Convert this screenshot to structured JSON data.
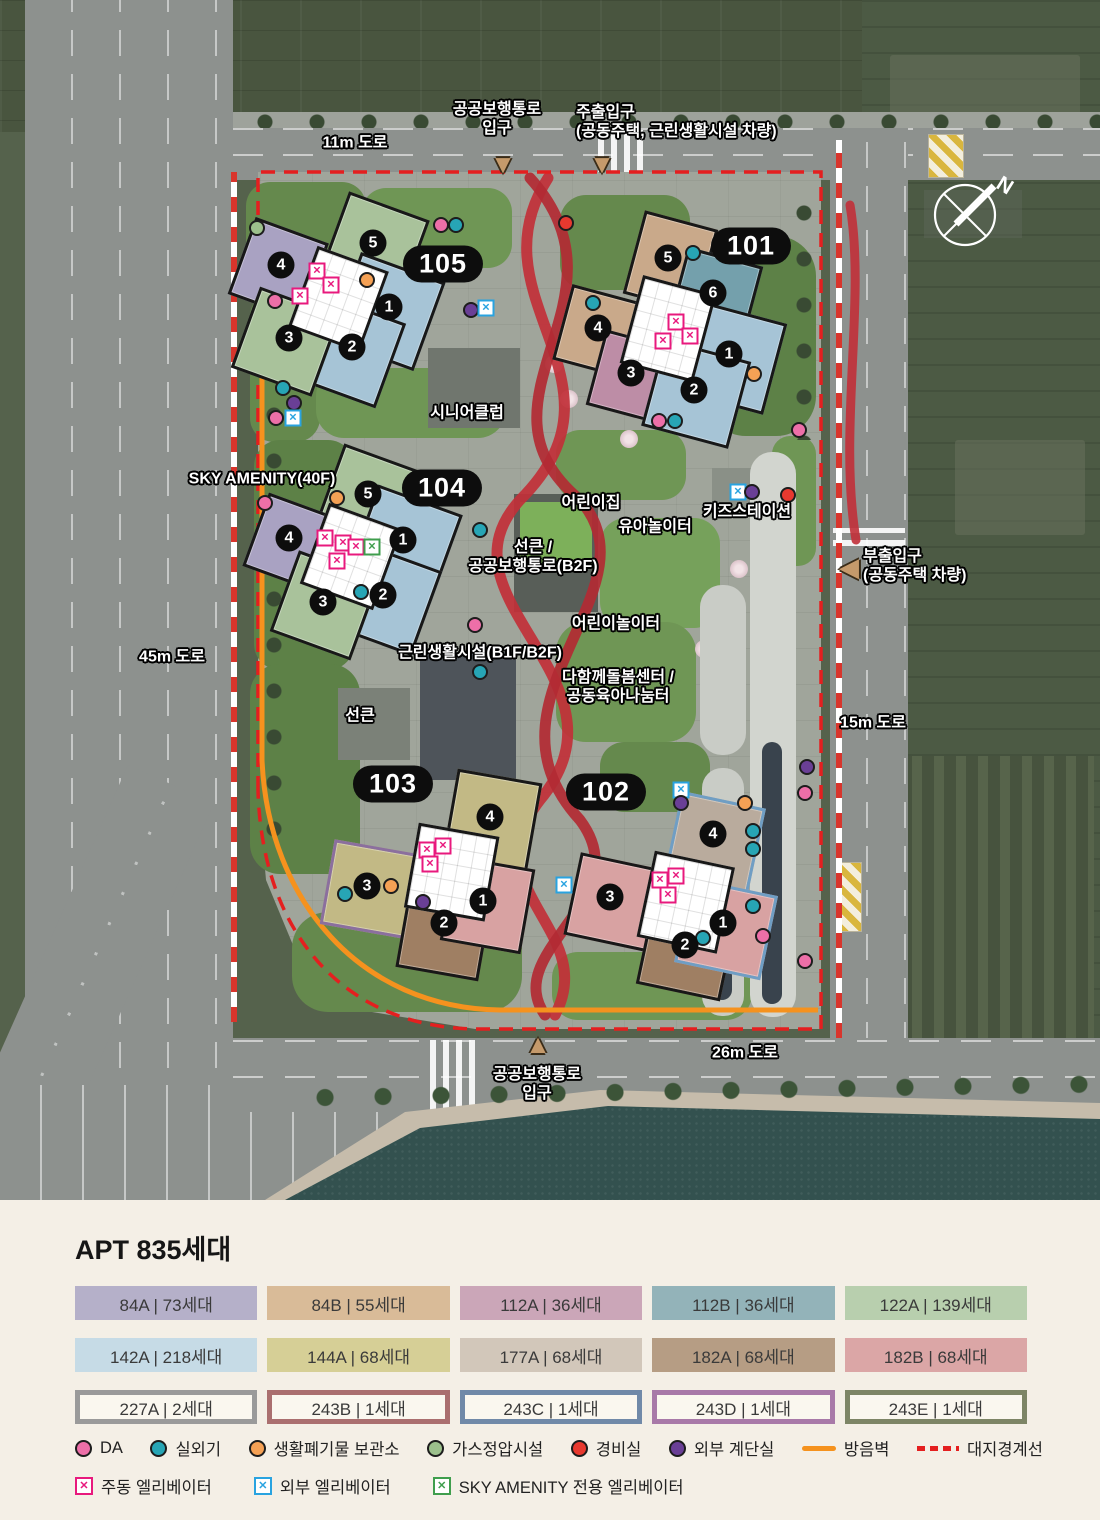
{
  "map": {
    "palette": {
      "da": "#ed6fa8",
      "ac": "#27a5b5",
      "waste": "#f5a155",
      "gas": "#9cc08c",
      "guard": "#e8392f",
      "stair": "#6a3f96",
      "em": "#e8197d",
      "ee": "#29a3e0",
      "es": "#3f9e4d",
      "wall": "#f5921e",
      "boundary": "#e41f1f",
      "ribbon": "#c13038"
    },
    "compass": {
      "label": "N"
    },
    "road_labels": [
      {
        "text": "11m 도로",
        "x": 355,
        "y": 143
      },
      {
        "text": "45m 도로",
        "x": 172,
        "y": 657
      },
      {
        "text": "15m 도로",
        "x": 873,
        "y": 723
      },
      {
        "text": "26m 도로",
        "x": 745,
        "y": 1053
      }
    ],
    "entrances": [
      {
        "id": "pedestrian-top",
        "lines": [
          "공공보행통로",
          "입구"
        ],
        "x": 497,
        "y": 119,
        "tri": "down",
        "tx": 503,
        "ty": 164
      },
      {
        "id": "main-gate",
        "lines": [
          "주출입구",
          "(공동주택, 근린생활시설 차량)"
        ],
        "align": "left",
        "x": 576,
        "y": 122,
        "tri": "down",
        "tx": 602,
        "ty": 164
      },
      {
        "id": "side-gate",
        "lines": [
          "부출입구",
          "(공동주택 차량)"
        ],
        "align": "left",
        "x": 863,
        "y": 566,
        "tri": "left",
        "tx": 849,
        "ty": 567
      },
      {
        "id": "pedestrian-bottom",
        "lines": [
          "공공보행통로",
          "입구"
        ],
        "x": 537,
        "y": 1084,
        "tri": "up",
        "tx": 538,
        "ty": 1044
      }
    ],
    "facilities": [
      {
        "text": "시니어클럽",
        "x": 467,
        "y": 413
      },
      {
        "text": "SKY AMENITY(40F)",
        "x": 262,
        "y": 479
      },
      {
        "text": "어린이집",
        "x": 591,
        "y": 503
      },
      {
        "text": "유아놀이터",
        "x": 655,
        "y": 527
      },
      {
        "text": "키즈스테이션",
        "x": 747,
        "y": 512
      },
      {
        "lines": [
          "선큰 /",
          "공공보행통로(B2F)"
        ],
        "x": 533,
        "y": 557
      },
      {
        "text": "어린이놀이터",
        "x": 616,
        "y": 624
      },
      {
        "lines": [
          "다함께돌봄센터 /",
          "공동육아나눔터"
        ],
        "x": 618,
        "y": 687
      },
      {
        "text": "근린생활시설(B1F/B2F)",
        "x": 480,
        "y": 653
      },
      {
        "text": "선큰",
        "x": 360,
        "y": 716
      }
    ],
    "buildings": [
      {
        "id": "105",
        "pill": {
          "x": 443,
          "y": 264
        },
        "numbers": [
          {
            "n": "5",
            "x": 373,
            "y": 243
          },
          {
            "n": "4",
            "x": 281,
            "y": 265
          },
          {
            "n": "1",
            "x": 389,
            "y": 307
          },
          {
            "n": "2",
            "x": 352,
            "y": 347
          },
          {
            "n": "3",
            "x": 289,
            "y": 338
          }
        ]
      },
      {
        "id": "101",
        "pill": {
          "x": 751,
          "y": 246
        },
        "numbers": [
          {
            "n": "5",
            "x": 668,
            "y": 258
          },
          {
            "n": "6",
            "x": 713,
            "y": 293
          },
          {
            "n": "4",
            "x": 598,
            "y": 328
          },
          {
            "n": "3",
            "x": 631,
            "y": 373
          },
          {
            "n": "1",
            "x": 729,
            "y": 354
          },
          {
            "n": "2",
            "x": 694,
            "y": 390
          }
        ]
      },
      {
        "id": "104",
        "pill": {
          "x": 442,
          "y": 488
        },
        "numbers": [
          {
            "n": "5",
            "x": 368,
            "y": 494
          },
          {
            "n": "4",
            "x": 289,
            "y": 538
          },
          {
            "n": "1",
            "x": 403,
            "y": 540
          },
          {
            "n": "2",
            "x": 383,
            "y": 595
          },
          {
            "n": "3",
            "x": 323,
            "y": 602
          }
        ]
      },
      {
        "id": "103",
        "pill": {
          "x": 393,
          "y": 784
        },
        "numbers": [
          {
            "n": "4",
            "x": 490,
            "y": 817
          },
          {
            "n": "3",
            "x": 367,
            "y": 886
          },
          {
            "n": "2",
            "x": 444,
            "y": 923
          },
          {
            "n": "1",
            "x": 483,
            "y": 901
          }
        ]
      },
      {
        "id": "102",
        "pill": {
          "x": 606,
          "y": 792
        },
        "numbers": [
          {
            "n": "4",
            "x": 713,
            "y": 834
          },
          {
            "n": "3",
            "x": 610,
            "y": 897
          },
          {
            "n": "2",
            "x": 685,
            "y": 945
          },
          {
            "n": "1",
            "x": 723,
            "y": 923
          }
        ]
      }
    ],
    "markers": [
      {
        "x": 257,
        "y": 228,
        "k": "gas"
      },
      {
        "x": 441,
        "y": 225,
        "k": "da"
      },
      {
        "x": 456,
        "y": 225,
        "k": "ac"
      },
      {
        "x": 367,
        "y": 280,
        "k": "waste"
      },
      {
        "x": 275,
        "y": 301,
        "k": "da"
      },
      {
        "x": 471,
        "y": 310,
        "k": "stair"
      },
      {
        "x": 486,
        "y": 308,
        "k": "ee"
      },
      {
        "x": 283,
        "y": 388,
        "k": "ac"
      },
      {
        "x": 294,
        "y": 403,
        "k": "stair"
      },
      {
        "x": 276,
        "y": 418,
        "k": "da"
      },
      {
        "x": 293,
        "y": 418,
        "k": "ee"
      },
      {
        "x": 566,
        "y": 223,
        "k": "guard"
      },
      {
        "x": 693,
        "y": 253,
        "k": "ac"
      },
      {
        "x": 593,
        "y": 303,
        "k": "ac"
      },
      {
        "x": 754,
        "y": 374,
        "k": "waste"
      },
      {
        "x": 659,
        "y": 421,
        "k": "da"
      },
      {
        "x": 675,
        "y": 421,
        "k": "ac"
      },
      {
        "x": 799,
        "y": 430,
        "k": "da"
      },
      {
        "x": 265,
        "y": 503,
        "k": "da"
      },
      {
        "x": 337,
        "y": 498,
        "k": "waste"
      },
      {
        "x": 480,
        "y": 530,
        "k": "ac"
      },
      {
        "x": 361,
        "y": 592,
        "k": "ac"
      },
      {
        "x": 475,
        "y": 625,
        "k": "da"
      },
      {
        "x": 480,
        "y": 672,
        "k": "ac"
      },
      {
        "x": 738,
        "y": 492,
        "k": "ee"
      },
      {
        "x": 752,
        "y": 492,
        "k": "stair"
      },
      {
        "x": 788,
        "y": 495,
        "k": "guard"
      },
      {
        "x": 807,
        "y": 767,
        "k": "stair"
      },
      {
        "x": 805,
        "y": 793,
        "k": "da"
      },
      {
        "x": 345,
        "y": 894,
        "k": "ac"
      },
      {
        "x": 391,
        "y": 886,
        "k": "waste"
      },
      {
        "x": 423,
        "y": 902,
        "k": "stair"
      },
      {
        "x": 564,
        "y": 885,
        "k": "ee"
      },
      {
        "x": 681,
        "y": 790,
        "k": "ee"
      },
      {
        "x": 681,
        "y": 803,
        "k": "stair"
      },
      {
        "x": 745,
        "y": 803,
        "k": "waste"
      },
      {
        "x": 753,
        "y": 831,
        "k": "ac"
      },
      {
        "x": 753,
        "y": 849,
        "k": "ac"
      },
      {
        "x": 753,
        "y": 906,
        "k": "ac"
      },
      {
        "x": 763,
        "y": 936,
        "k": "da"
      },
      {
        "x": 703,
        "y": 938,
        "k": "ac"
      },
      {
        "x": 805,
        "y": 961,
        "k": "da"
      },
      {
        "x": 317,
        "y": 271,
        "k": "em"
      },
      {
        "x": 331,
        "y": 285,
        "k": "em"
      },
      {
        "x": 300,
        "y": 296,
        "k": "em"
      },
      {
        "x": 676,
        "y": 322,
        "k": "em"
      },
      {
        "x": 690,
        "y": 336,
        "k": "em"
      },
      {
        "x": 663,
        "y": 341,
        "k": "em"
      },
      {
        "x": 325,
        "y": 538,
        "k": "em"
      },
      {
        "x": 343,
        "y": 543,
        "k": "em"
      },
      {
        "x": 356,
        "y": 547,
        "k": "em"
      },
      {
        "x": 337,
        "y": 561,
        "k": "em"
      },
      {
        "x": 372,
        "y": 547,
        "k": "es"
      },
      {
        "x": 427,
        "y": 850,
        "k": "em"
      },
      {
        "x": 443,
        "y": 846,
        "k": "em"
      },
      {
        "x": 430,
        "y": 864,
        "k": "em"
      },
      {
        "x": 660,
        "y": 880,
        "k": "em"
      },
      {
        "x": 676,
        "y": 876,
        "k": "em"
      },
      {
        "x": 668,
        "y": 895,
        "k": "em"
      }
    ]
  },
  "legend": {
    "title": "APT 835세대",
    "chips": [
      {
        "text": "84A | 73세대",
        "bg": "#b5b0c9"
      },
      {
        "text": "84B | 55세대",
        "bg": "#d9bb98"
      },
      {
        "text": "112A | 36세대",
        "bg": "#cba6b8"
      },
      {
        "text": "112B | 36세대",
        "bg": "#93b3b9"
      },
      {
        "text": "122A | 139세대",
        "bg": "#b8cfae"
      },
      {
        "text": "142A | 218세대",
        "bg": "#c6dbe6"
      },
      {
        "text": "144A | 68세대",
        "bg": "#d6cf96"
      },
      {
        "text": "177A | 68세대",
        "bg": "#d2c7ba"
      },
      {
        "text": "182A | 68세대",
        "bg": "#b69d84"
      },
      {
        "text": "182B | 68세대",
        "bg": "#dba6a6"
      },
      {
        "text": "227A | 2세대",
        "border": "#9a9a9a"
      },
      {
        "text": "243B | 1세대",
        "border": "#aa6f6f"
      },
      {
        "text": "243C | 1세대",
        "border": "#7089a8"
      },
      {
        "text": "243D | 1세대",
        "border": "#a879a8"
      },
      {
        "text": "243E | 1세대",
        "border": "#7d8566"
      }
    ],
    "markers": [
      {
        "label": "DA",
        "type": "dot",
        "color": "#ed6fa8"
      },
      {
        "label": "실외기",
        "type": "dot",
        "color": "#27a5b5"
      },
      {
        "label": "생활폐기물 보관소",
        "type": "dot",
        "color": "#f5a155"
      },
      {
        "label": "가스정압시설",
        "type": "dot",
        "color": "#9cc08c"
      },
      {
        "label": "경비실",
        "type": "dot",
        "color": "#e8392f"
      },
      {
        "label": "외부 계단실",
        "type": "dot",
        "color": "#6a3f96"
      },
      {
        "label": "방음벽",
        "type": "line",
        "color": "#f5921e"
      },
      {
        "label": "대지경계선",
        "type": "dashed",
        "color": "#e41f1f"
      }
    ],
    "elevators": [
      {
        "label": "주동 엘리베이터",
        "color": "#e8197d"
      },
      {
        "label": "외부 엘리베이터",
        "color": "#29a3e0"
      },
      {
        "label": "SKY AMENITY 전용 엘리베이터",
        "color": "#3f9e4d"
      }
    ]
  }
}
